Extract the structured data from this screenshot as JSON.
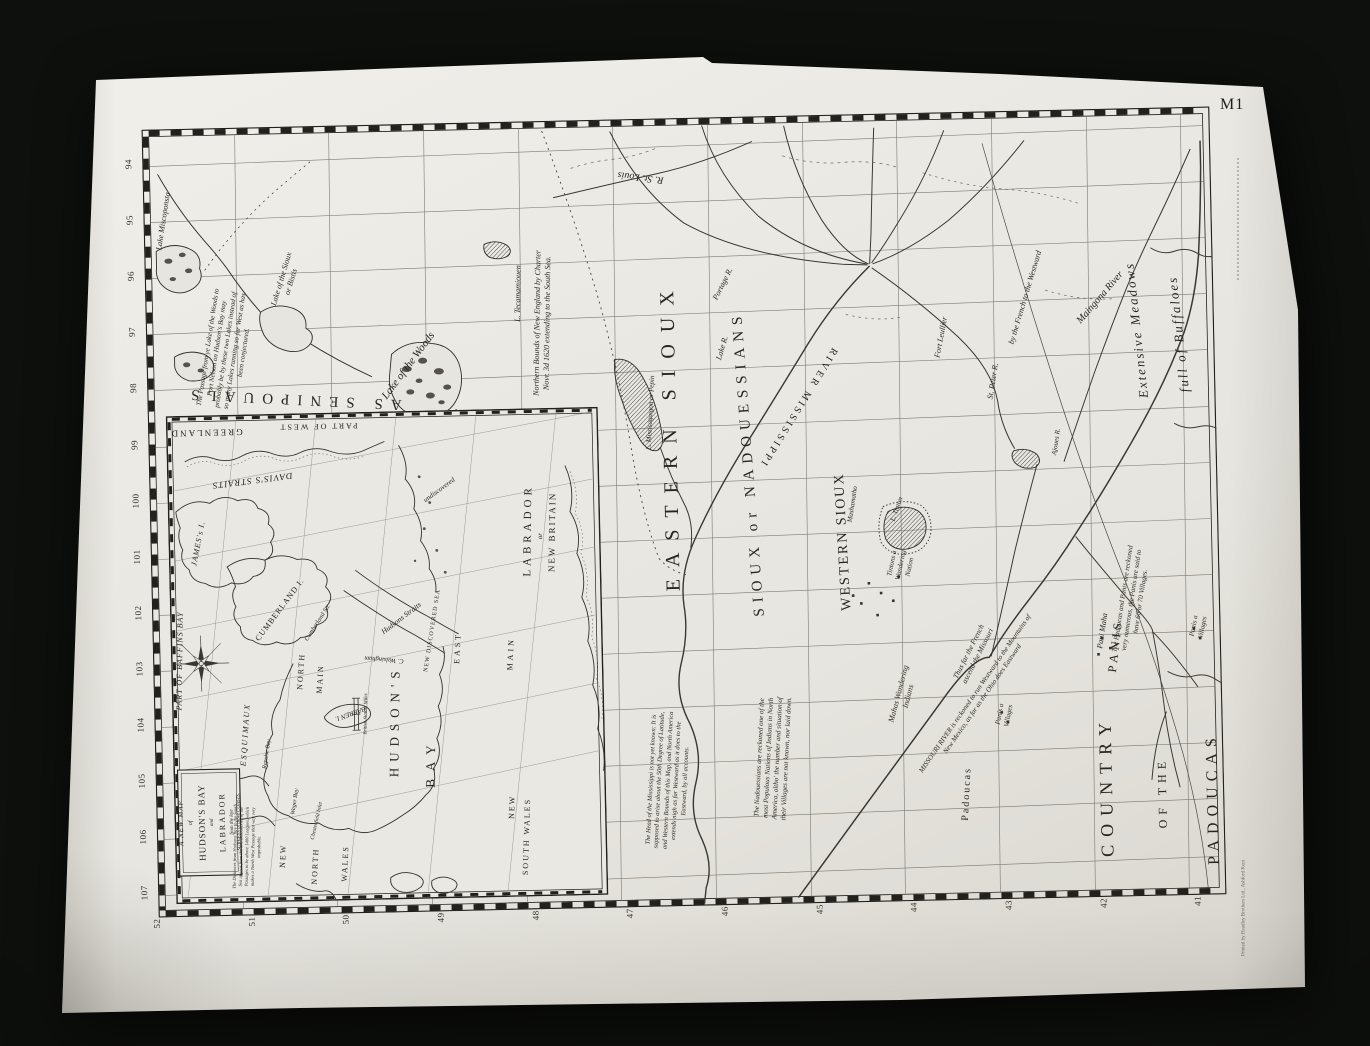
{
  "photo": {
    "sheet_code": "M1",
    "printer_line": "Printed by Headley Brothers Ltd., Ashford Kent"
  },
  "map": {
    "edge_longitudes": [
      "94",
      "95",
      "96",
      "97",
      "98",
      "99",
      "100",
      "101",
      "102",
      "103",
      "104",
      "105",
      "106",
      "107"
    ],
    "edge_latitudes": [
      "52",
      "51",
      "50",
      "49",
      "48",
      "47",
      "46",
      "45",
      "44",
      "43",
      "42",
      "41"
    ],
    "regions": {
      "eastern_sioux": "EASTERN SIOUX",
      "sioux_nadouessians": "SIOUX or NADOUESSIANS",
      "western_sioux": "WESTERN SIOUX",
      "country": "COUNTRY",
      "of_the": "OF THE",
      "padoucas_big": "PADOUCAS",
      "assenipouals": "AS SENIPOUALS",
      "extensive_meadows": "Extensive Meadows",
      "full_of_buffaloes": "full of Buffaloes",
      "panis_big": "PANIS",
      "padoucas_small": "Padoucas"
    },
    "places": {
      "lake_of_the_woods": "Lake of the Woods",
      "lake_sioux": "Lake of the Sioux or Bistis",
      "lake_miscoponsta": "Lake Miscoponsta",
      "l_tecamamiouen": "L. Tecamamiouen",
      "r_st_louis": "R. St. Louis",
      "portage_r": "Portage R.",
      "lake_r": "Lake R.",
      "l_missisagaigon": "L. Missisagaigon or Pepin",
      "river_mississippi": "RIVER MISSISSIPPI",
      "st_peter": "St. Peter R.",
      "fort_leullier": "Fort Leullier",
      "mashamatho": "Mashamatho",
      "l_tinton": "L. Tinton",
      "tintons": "Tintons a Wandering Nation",
      "mahas": "Mahas Wandering Indians",
      "maingona": "Maingona River",
      "ajoues": "Ajoues R.",
      "pani_maha": "Pani Maha",
      "panis_villages": "Panis a Villages",
      "french_boundary": "by the French to the Westward",
      "missouri_course": "MISSOURI RIVER is reckoned to run Westward to the Mountains of New Mexico, as far as the Ohio does Eastward"
    },
    "notes": {
      "passage": "The Passage from ye Lake of the Woods to Port Nelson on Hudson's Bay may probably be by these two Lakes instead of so many Lakes running so far West as has been conjectured.",
      "new_england": "Northern Bounds of New England by Charter Novr. 3d 1620 extending to the South Sea.",
      "mississippi_head": "The Head of the Mississippi is not yet known: It is supposed to arise about the 50th Degree of Latitude, and Western Bounds of this Map, and North America extends nigh as far Westward as it does to the Eastward, by all accounts.",
      "nadouessians": "The Nadouessians are reckoned one of the most Populous Nations of Indians in North America, altho' the number and situation of their Villages are not known, nor laid down.",
      "padoucas": "The Padoucas and Panis are reckoned very numerous, the Panis are said to have 60 or 70 Villages.",
      "french_missouri": "Thus far the French ascend the Missouri"
    }
  },
  "inset": {
    "title": {
      "l1": "A NEW MAP",
      "l2": "of",
      "l3": "HUDSON'S BAY",
      "l4": "and",
      "l5": "LABRADOR",
      "l6": "from the late",
      "l7": "SURVEYS of those COASTS."
    },
    "note": "The Distances from Hudsons Bay to the South Sea appear from the late Discoveries of the Passages to be above 1400 Leagues, which makes a North West Passage that way very improbable.",
    "labels": {
      "greenland": "GREENLAND",
      "part_of_west": "PART OF WEST",
      "daviss_straits": "DAVIS'S STRAITS",
      "jamess_i": "JAMES's I.",
      "cumberland_i": "CUMBERLAND I.",
      "cumberland_str": "Cumberland Str.",
      "undiscovered": "undiscovered",
      "baffins_bay": "PART OF BAFFINS BAY",
      "esquimaux": "ESQUIMAUX",
      "repulse_bay": "Repulse Bay",
      "wager_bay": "Wager Bay",
      "chesterfield": "Chesterfield Inlet",
      "north_main_n": "NORTH",
      "north_main_m": "MAIN",
      "hudsons": "HUDSON'S",
      "bay": "BAY",
      "barren_i": "BARREN I.",
      "new_discovered": "NEW DISCOVERED SEA",
      "c_walsingham": "C. Walsingham",
      "hudsons_straits": "Hudsons Straits",
      "new_1": "NEW",
      "north_2": "NORTH",
      "wales_1": "WALES",
      "east_main_e": "EAST",
      "east_main_m": "MAIN",
      "labrador": "LABRADOR",
      "or_word": "or",
      "new_britain": "NEW BRITAIN",
      "new_2": "NEW",
      "south_wales": "SOUTH WALES",
      "scale_label": "British Statute Miles"
    }
  }
}
